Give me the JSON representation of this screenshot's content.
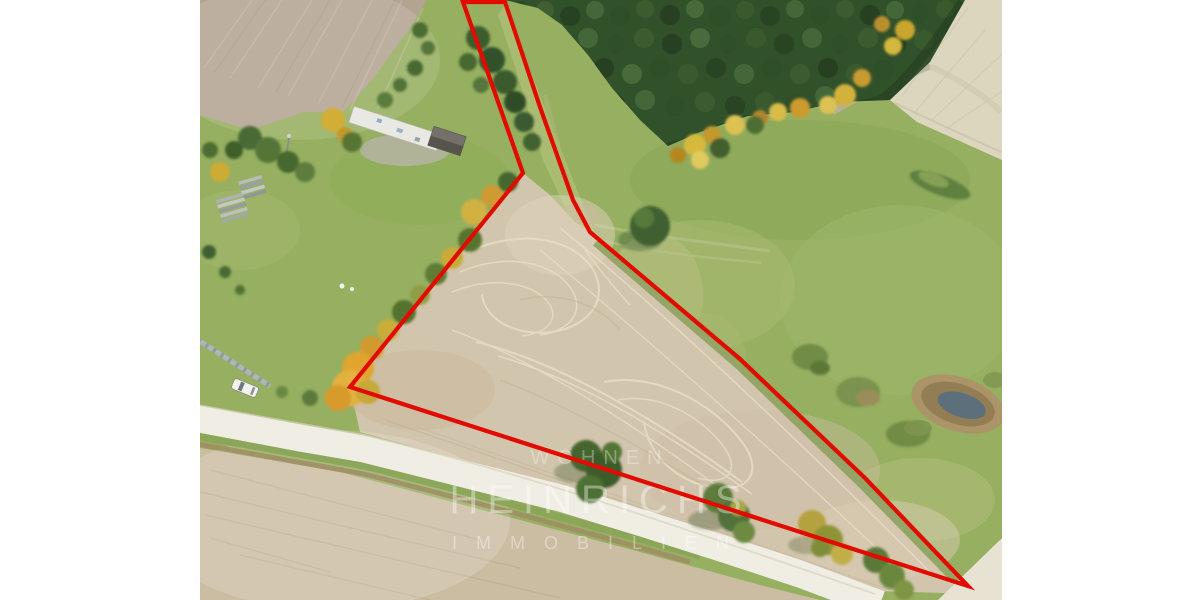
{
  "photo": {
    "kind_label": "aerial-drone-photo-of-building-plot",
    "watermark": {
      "line1": "WOHNEN",
      "line2": "HEINRICHS",
      "line3": "IMMOBILIEN"
    },
    "colors": {
      "matte_white": "#ffffff",
      "boundary_red": "#e10b00",
      "meadow_green": "#96af60",
      "forest_green": "#31512b",
      "plot_field_tan": "#d2c5ad",
      "road_white": "#f0eee4",
      "pond_water": "#5d6f7a",
      "autumn_yellow": "#d4b83c",
      "watermark_white": "#ffffff"
    }
  }
}
